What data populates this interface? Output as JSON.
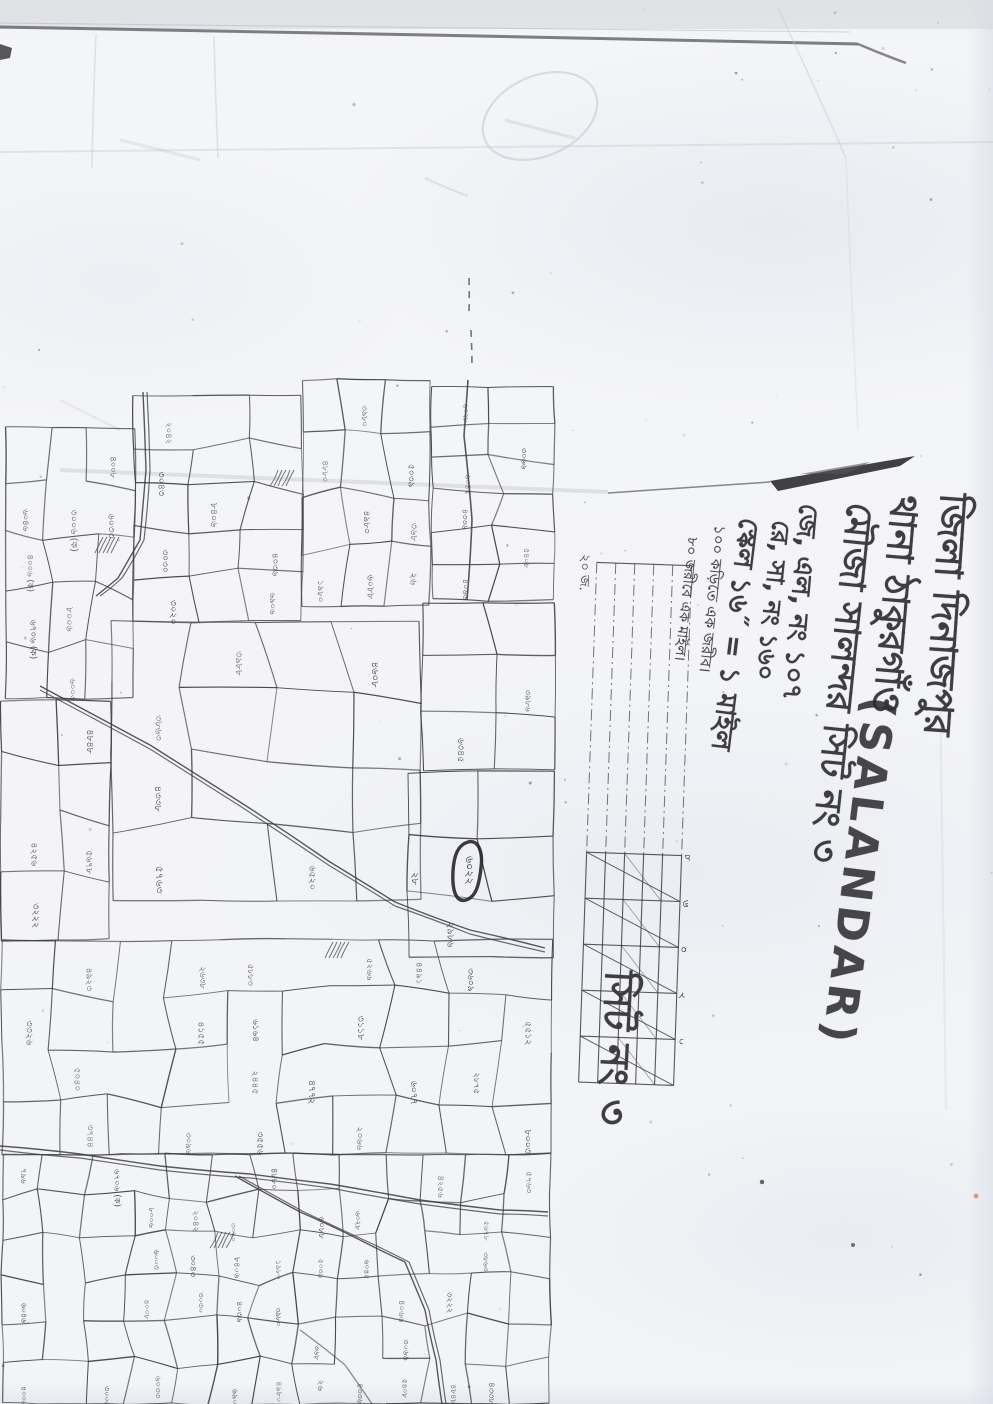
{
  "header": {
    "district_line": "জিলা দিনাজপুর",
    "thana_line": "থানা ঠাকুরগাঁও",
    "mouza_line": "মৌজা সালন্দর সিট নং ৩",
    "mouza_latin": "(SALANDAR)",
    "jl_line": "জে, এল, নং ১০৭",
    "rs_line": "রে, সা, নং ১৬০",
    "scale_line": "স্কেল ১৬˝ = ১ মাইল",
    "scale_note1": "১০০ কড়িতে এক জরীব।",
    "scale_note2": "৮০ জরীবে এক মাইল।"
  },
  "annotations": {
    "sheet_label": "সিট নং ৩",
    "highlighted_plot": "৬০২২",
    "adjacent_plot": "২৮"
  },
  "scale_bar": {
    "tick_labels": [
      "৮",
      "৬",
      "৪",
      "২",
      "০"
    ],
    "end_label": "২০ জ."
  },
  "map": {
    "plot_numbers": [
      "৬০৪৬",
      "৪০০৬ (ক)",
      "৬৭০৬ (ক)",
      "৩০০৬ (ক)",
      "৮০০৬",
      "৬০০৩",
      "৪০০৮",
      "৬০৩৩",
      "২০৪২",
      "৩০৪৩",
      "৩০৩০",
      "৩০২০",
      "৮৪০৬",
      "৪০৩৬",
      "৬৯০৬",
      "৪৮৮০",
      "১৯৮০",
      "৩৯৮০",
      "৪৯৮০",
      "৬০৮৮",
      "৫০৩৯",
      "৩৬৮",
      "২৬",
      "৬০২৮",
      "৬০৪৫",
      "৪৩৩৬",
      "৪০৬৬",
      "৩০৬৬",
      "৫৪০৮",
      "৪২৫৬",
      "৩২২২",
      "৪৮৪৮",
      "৫৬৭৮",
      "৩৮৬৩",
      "৪৩৩৮",
      "৫৭৬৩",
      "৩৯৮৮",
      "৬৫২০",
      "৪৬০৮",
      "৬৩৪৫",
      "৩৯৮৬",
      "২৯৮৬",
      "৩৩২৬",
      "৪৯২৩",
      "৫০৪০",
      "৩৭৪৪",
      "২৬৩৮",
      "৪১৫৫",
      "৩০৯৬",
      "৫৮৮৩",
      "৬১৬৪",
      "২৪৪৫",
      "৩৫৫৬",
      "৪৭৭২",
      "৫২৬৬",
      "৩১১৮",
      "২০৬৬",
      "৪৪৯১",
      "৬০৭৭",
      "৩৬০৯",
      "২৮৭৫",
      "৫৫১২",
      "৮০০৩",
      "৭৯৬"
    ]
  },
  "colors": {
    "ink": "#3b3b42",
    "dark_ink": "#26262b",
    "paper": "#f3f4f7",
    "crease": "#c9ccd4"
  }
}
